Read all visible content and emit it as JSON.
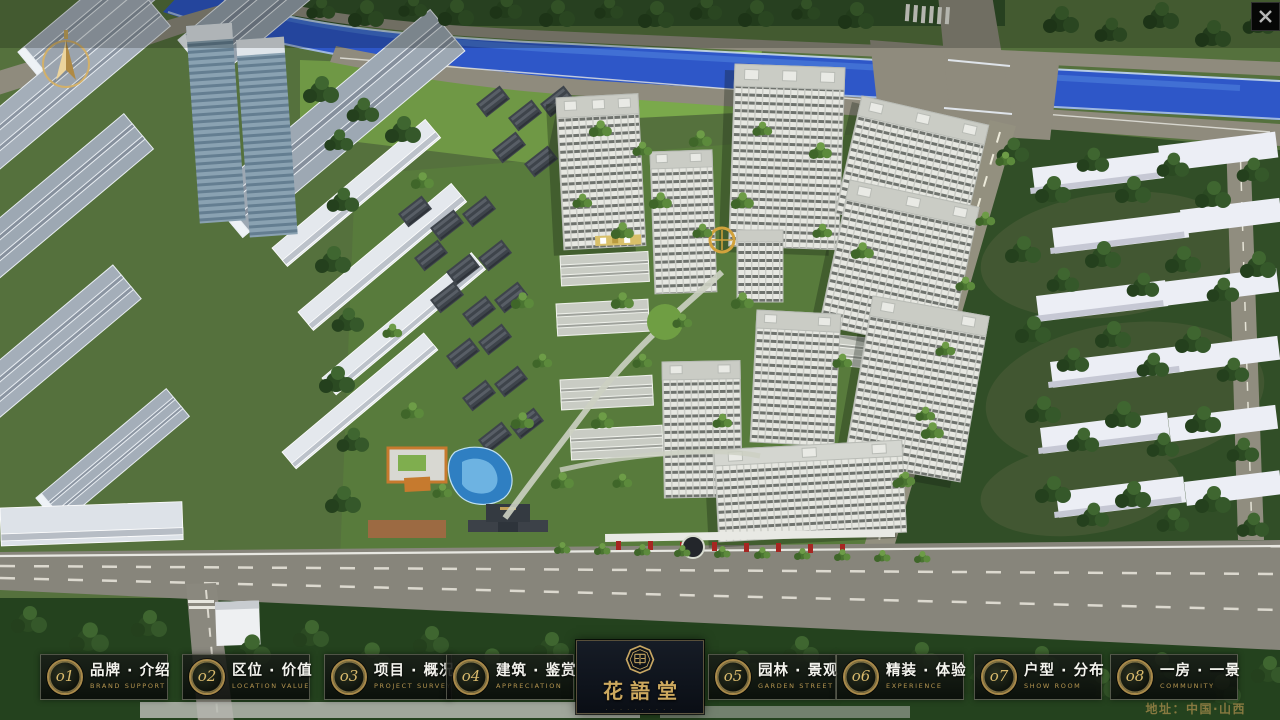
{
  "scene": {
    "description": "aerial 3D masterplan render of residential community",
    "colors": {
      "gold": "#c2a059",
      "river_blue": "#2e57c8",
      "lawn_green": "#7aa94b",
      "bar_bg": "#0c100c"
    }
  },
  "window": {
    "close_label": "✕"
  },
  "logo": {
    "title": "花語堂",
    "subtitle": "· · · · · · · · · ·"
  },
  "menu": {
    "items": [
      {
        "num": "o1",
        "cn": "品牌 · 介绍",
        "en": "BRAND SUPPORT"
      },
      {
        "num": "o2",
        "cn": "区位 · 价值",
        "en": "LOCATION VALUE"
      },
      {
        "num": "o3",
        "cn": "项目 · 概况",
        "en": "PROJECT SURVEY"
      },
      {
        "num": "o4",
        "cn": "建筑 · 鉴赏",
        "en": "APPRECIATION"
      },
      {
        "num": "o5",
        "cn": "园林 · 景观",
        "en": "GARDEN STREET"
      },
      {
        "num": "o6",
        "cn": "精装 · 体验",
        "en": "EXPERIENCE"
      },
      {
        "num": "o7",
        "cn": "户型 · 分布",
        "en": "SHOW ROOM"
      },
      {
        "num": "o8",
        "cn": "一房 · 一景",
        "en": "COMMUNITY"
      }
    ]
  },
  "footer": {
    "address": "地址：中国·山西"
  }
}
